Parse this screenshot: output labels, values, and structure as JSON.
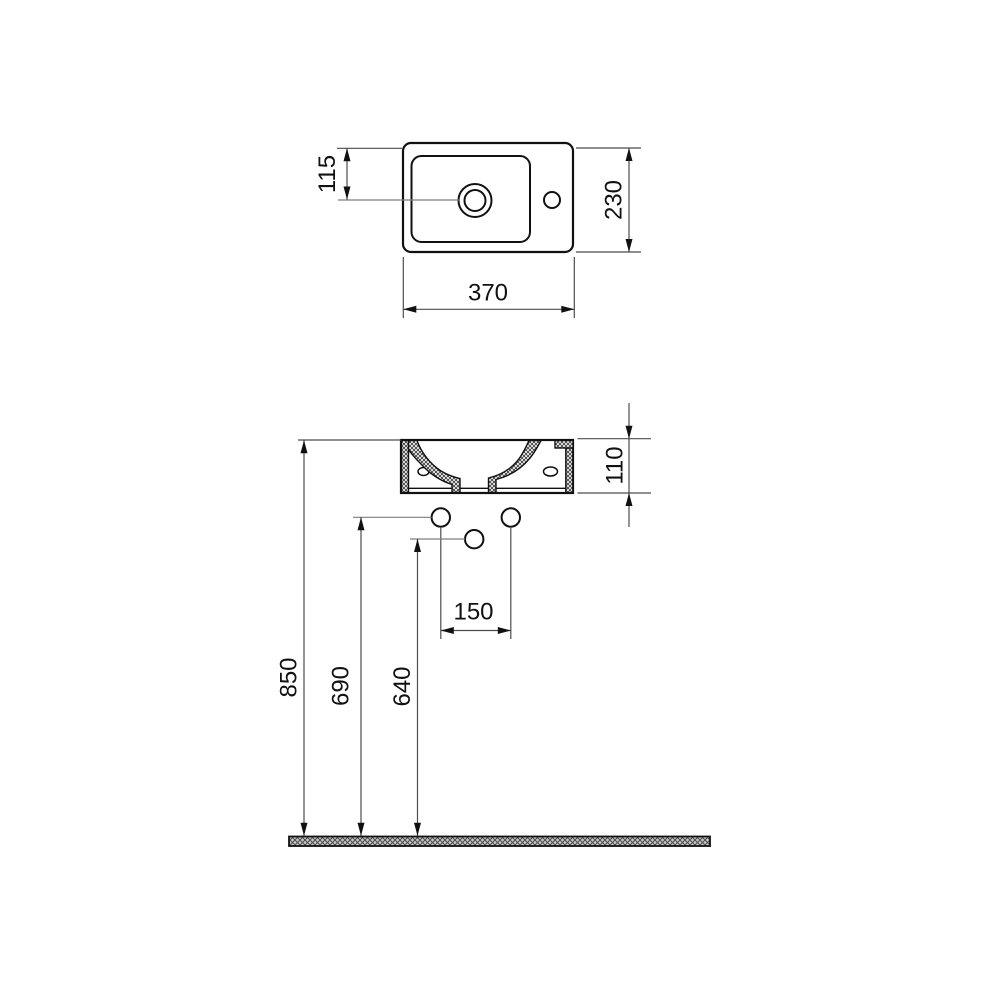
{
  "drawing": {
    "background": "#ffffff",
    "outline_color": "#111111",
    "dim_line_color": "#4d4d4d",
    "leader_color": "#7d7d7d",
    "views": {
      "top_view": {
        "dims": {
          "tap_hole_offset": "115",
          "depth": "230",
          "width": "370"
        }
      },
      "front_view": {
        "dims": {
          "basin_height": "110",
          "fixing_hole_spacing": "150",
          "rim_height": "850",
          "fixing_holes_height": "690",
          "center_hole_height": "640"
        }
      }
    }
  }
}
